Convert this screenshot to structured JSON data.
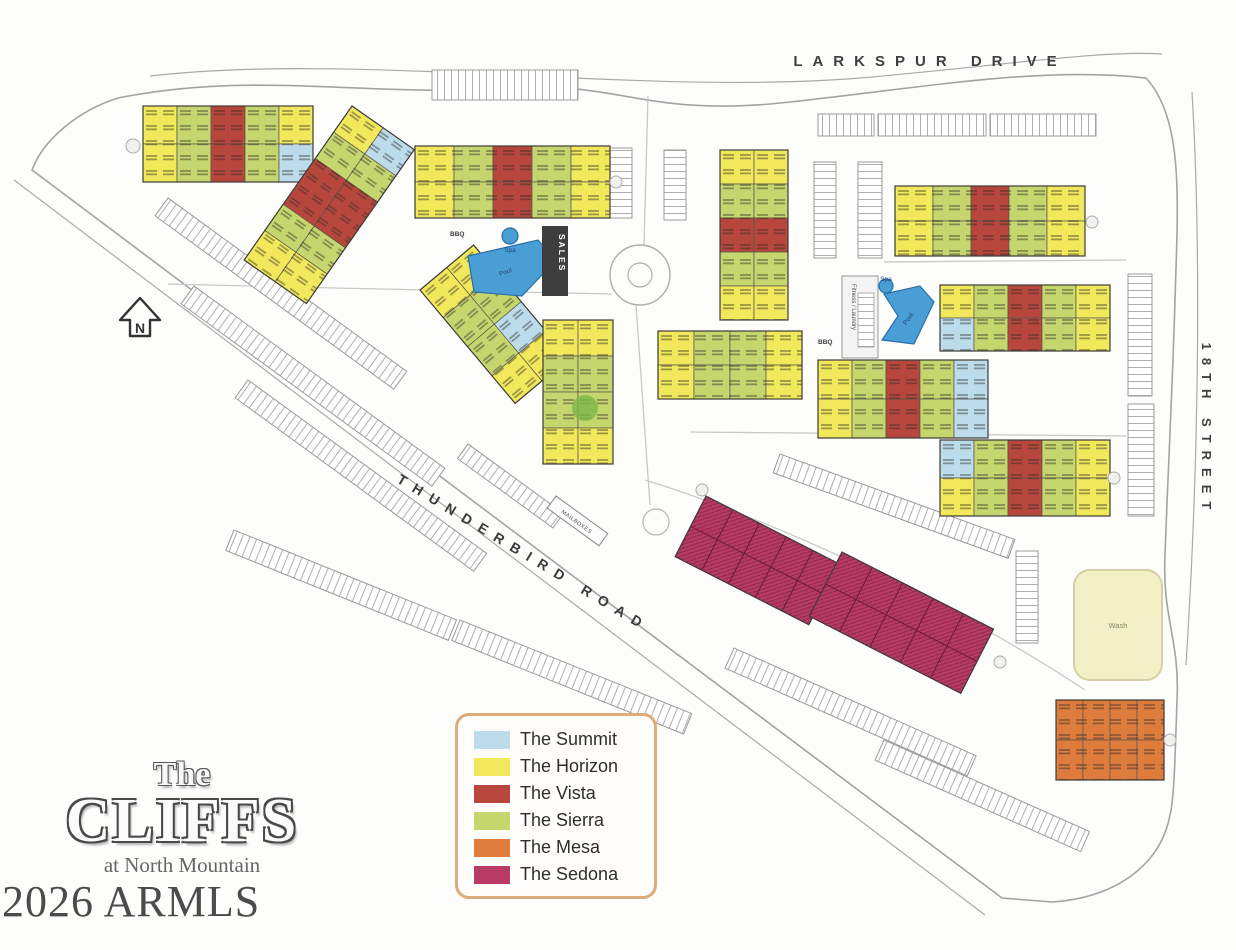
{
  "roads": {
    "larkspur_drive": "LARKSPUR DRIVE",
    "eighteenth_street": "18TH STREET",
    "thunderbird_road": "THUNDERBIRD ROAD"
  },
  "compass": {
    "north": "N"
  },
  "amenities": {
    "bbq_a": "BBQ",
    "pool_a": "Pool",
    "spa_a": "Spa",
    "sales": "SALES",
    "bbq_b": "BBQ",
    "pool_b": "Pool",
    "spa_b": "Spa",
    "fitness_laundry": "Fitness / Laundry",
    "mailboxes": "MAILBOXES",
    "wash": "Wash"
  },
  "legend": {
    "items": [
      {
        "key": "summit",
        "label": "The Summit",
        "color": "#bcdcec"
      },
      {
        "key": "horizon",
        "label": "The Horizon",
        "color": "#f1e85c"
      },
      {
        "key": "vista",
        "label": "The Vista",
        "color": "#b7473c"
      },
      {
        "key": "sierra",
        "label": "The Sierra",
        "color": "#c6d66e"
      },
      {
        "key": "mesa",
        "label": "The Mesa",
        "color": "#de7c3e"
      },
      {
        "key": "sedona",
        "label": "The Sedona",
        "color": "#b93a64"
      }
    ]
  },
  "logo": {
    "line1": "The",
    "line2": "CLIFFS",
    "line3": "at North Mountain"
  },
  "watermark": "2026 ARMLS",
  "colors": {
    "summit": "#bcdcec",
    "horizon": "#f1e85c",
    "vista": "#b7473c",
    "sierra": "#c6d66e",
    "mesa": "#de7c3e",
    "sedona": "#b93a64",
    "pool": "#4a9ed6",
    "wash": "#f3efc6",
    "sales": "#3e3e3e",
    "tree": "#7ab648"
  }
}
